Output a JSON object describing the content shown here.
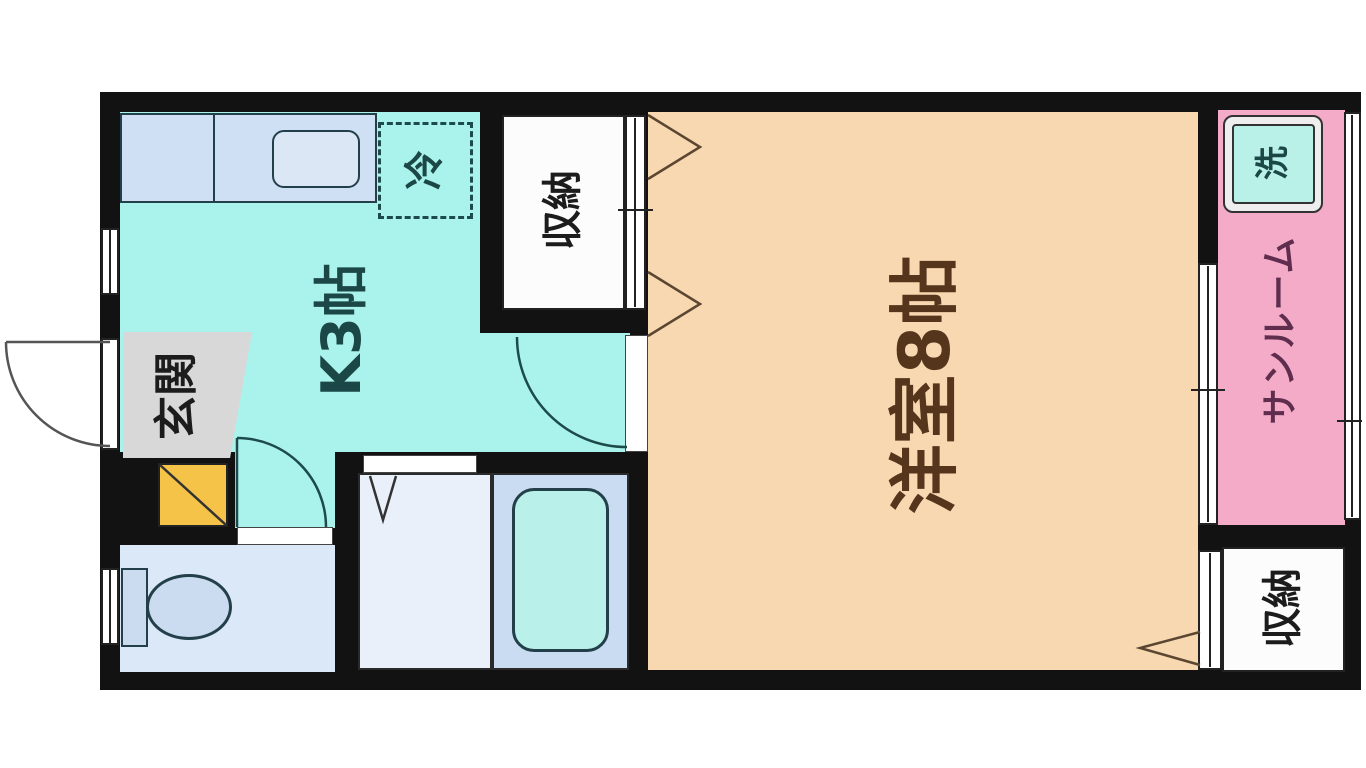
{
  "floorplan": {
    "background": "#ffffff",
    "wall_color": "#121212",
    "line_color": "#23404a",
    "rooms": {
      "kitchen": {
        "label": "K3帖",
        "color": "#a9f3ec",
        "text_color": "#1c4747"
      },
      "living": {
        "label": "洋室8帖",
        "color": "#f8d8b0",
        "text_color": "#55361d"
      },
      "entrance": {
        "label": "玄関",
        "color": "#d8d8d8",
        "text_color": "#1c1c1c"
      },
      "closet_top": {
        "label": "収納",
        "color": "#fcfcfc",
        "text_color": "#1c1c1c"
      },
      "closet_bottom": {
        "label": "収納",
        "color": "#fcfcfc",
        "text_color": "#1c1c1c"
      },
      "sunroom": {
        "label": "サンルーム",
        "color": "#f3abc8",
        "text_color": "#5f2d4e"
      },
      "toilet": {
        "color": "#dbe8f7"
      },
      "washroom": {
        "color": "#e9f0fa"
      },
      "bathroom": {
        "color": "#c9dcf2"
      }
    },
    "fixtures": {
      "refrigerator": {
        "label": "冷",
        "text_color": "#1c4747"
      },
      "washing_machine": {
        "label": "洗",
        "color": "#b9f1e9",
        "ring_color": "#eeeeee",
        "text_color": "#1c4747"
      },
      "bathtub": {
        "color": "#baf0ea"
      },
      "kitchen_counter": {
        "color": "#cfe0f4"
      },
      "sink": {
        "color": "#dbe7f5"
      },
      "toilet_fixture": {
        "color": "#ccdcf0"
      },
      "shoe_cabinet": {
        "color": "#f5c348"
      },
      "door_gap": {
        "color": "#ffffff"
      }
    }
  }
}
